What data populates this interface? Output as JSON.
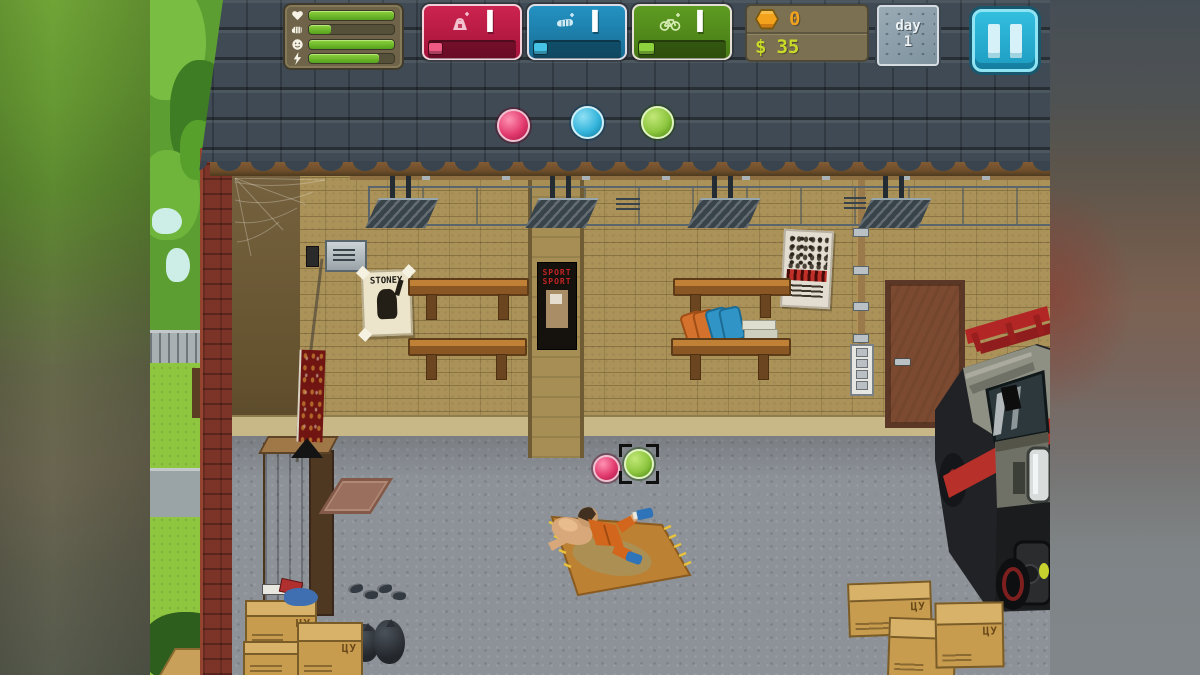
{
  "hud": {
    "needs": {
      "rows": [
        {
          "icon": "heart-icon",
          "value": 100
        },
        {
          "icon": "fist-icon",
          "value": 26
        },
        {
          "icon": "mood-icon",
          "value": 100
        },
        {
          "icon": "energy-icon",
          "value": 82
        }
      ]
    },
    "stats": [
      {
        "name": "strength",
        "icon": "kettlebell-icon",
        "level": "I",
        "progress": 15,
        "color": "#c01e44"
      },
      {
        "name": "agility",
        "icon": "fist-icon",
        "level": "I",
        "progress": 15,
        "color": "#1e85ae"
      },
      {
        "name": "stamina",
        "icon": "bicycle-icon",
        "level": "I",
        "progress": 18,
        "color": "#53901e"
      }
    ],
    "currency": {
      "coins": "0",
      "cash_symbol": "$",
      "cash": "35"
    },
    "calendar": {
      "label": "day",
      "value": "1"
    }
  },
  "scene": {
    "posters": {
      "stoney": "STONEY",
      "sport_line1": "SPORT",
      "sport_line2": "SPORT"
    },
    "box_stamp": "ЦУ",
    "orb_colors": {
      "pink": "#e8457a",
      "blue": "#35b5dc",
      "green": "#8dc63f"
    }
  }
}
